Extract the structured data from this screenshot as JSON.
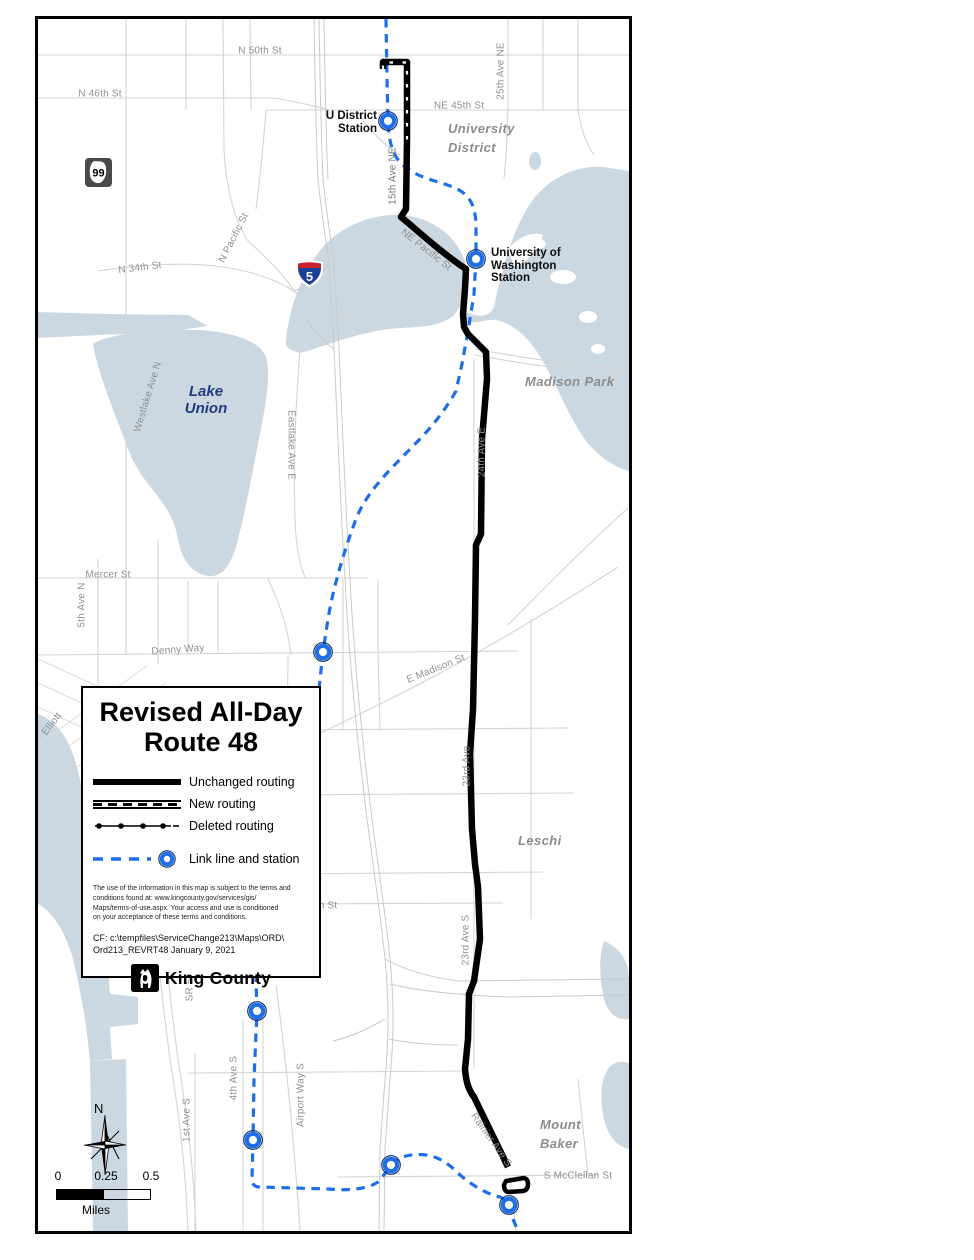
{
  "shields": {
    "sr99": "99",
    "i5": "5"
  },
  "colors": {
    "water": "#ccd8e1",
    "street": "#d4d4d4",
    "route": "#000000",
    "link_blue": "#1d6ee8",
    "area_label": "#8c8c8c",
    "lake_label": "#1e3e7a"
  },
  "streets": [
    {
      "text": "N 50th St"
    },
    {
      "text": "N 46th St"
    },
    {
      "text": "NE 45th St"
    },
    {
      "text": "25th Ave NE"
    },
    {
      "text": "15th Ave NE"
    },
    {
      "text": "NE Pacific St"
    },
    {
      "text": "N Pacific St"
    },
    {
      "text": "N 34th St"
    },
    {
      "text": "Westlake Ave N"
    },
    {
      "text": "Eastlake Ave E"
    },
    {
      "text": "24th Ave E"
    },
    {
      "text": "Mercer St"
    },
    {
      "text": "5th Ave N"
    },
    {
      "text": "Denny Way"
    },
    {
      "text": "E Madison St"
    },
    {
      "text": "23rd Ave"
    },
    {
      "text": "Elliott"
    },
    {
      "text": "n St"
    },
    {
      "text": "23rd Ave S"
    },
    {
      "text": "SR 51"
    },
    {
      "text": "4th Ave S"
    },
    {
      "text": "Airport Way S"
    },
    {
      "text": "1st Ave S"
    },
    {
      "text": "Rainier Ave S"
    },
    {
      "text": "S McClellan St"
    }
  ],
  "areas": {
    "lake_union": [
      "Lake",
      "Union"
    ],
    "university": [
      "University",
      "District"
    ],
    "madison": "Madison Park",
    "leschi": "Leschi",
    "mount_baker": [
      "Mount",
      "Baker"
    ]
  },
  "stations": {
    "u_district": [
      "U District",
      "Station"
    ],
    "uw": [
      "University of",
      "Washington",
      "Station"
    ]
  },
  "legend": {
    "title1": "Revised All-Day",
    "title2": "Route 48",
    "items": [
      {
        "label": "Unchanged routing"
      },
      {
        "label": "New routing"
      },
      {
        "label": "Deleted routing"
      },
      {
        "label": "Link line and station"
      }
    ],
    "disclaimer": [
      "The use of the information in this map is subject to the terms and",
      "conditions found at:  www.kingcounty.gov/services/gis/",
      "Maps/terms-of-use.aspx. Your access and use is conditioned",
      "on your acceptance of these terms and conditions."
    ],
    "cf": [
      "CF:  c:\\tempfiles\\ServiceChange213\\Maps\\ORD\\",
      "Ord213_REVRT48   January 9, 2021"
    ],
    "logo_text": "King County"
  },
  "north": {
    "label": "N"
  },
  "scalebar": {
    "t0": "0",
    "t1": "0.25",
    "t2": "0.5",
    "unit": "Miles"
  }
}
